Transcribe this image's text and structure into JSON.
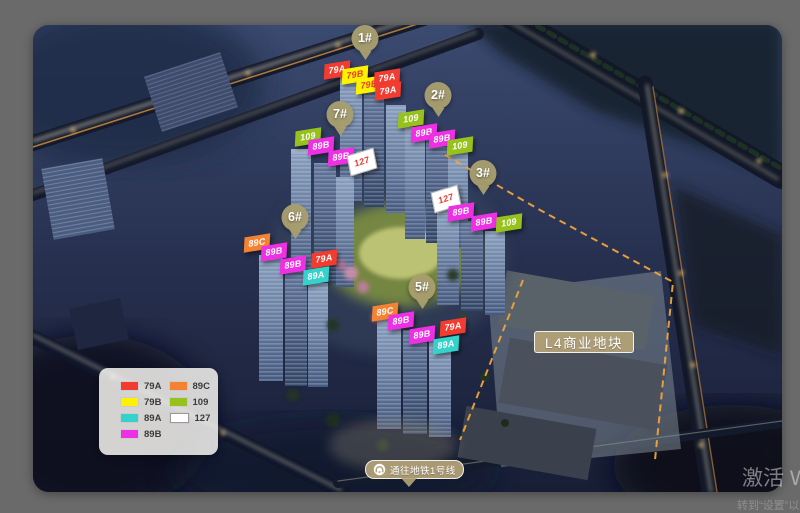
{
  "window": {
    "background_color": "#6a6a6a",
    "watermark": {
      "line1": "激活 Wi",
      "line2_partial": "转到“设置”以激活"
    }
  },
  "plan": {
    "unit_types": {
      "79A": {
        "bg": "#f23c30",
        "fg": "#ffffff"
      },
      "79B": {
        "bg": "#fdf200",
        "fg": "#e8392f"
      },
      "89A": {
        "bg": "#35d1cb",
        "fg": "#ffffff"
      },
      "89B": {
        "bg": "#ee30e4",
        "fg": "#ffffff"
      },
      "89C": {
        "bg": "#f58233",
        "fg": "#ffffff"
      },
      "109": {
        "bg": "#97c21e",
        "fg": "#ffffff"
      },
      "127": {
        "bg": "#ffffff",
        "fg": "#e8392f"
      }
    },
    "buildings": [
      {
        "name": "1#",
        "badge": {
          "x": 365,
          "y": 43
        },
        "units": [
          {
            "type": "79A",
            "x": 337,
            "y": 70
          },
          {
            "type": "79B",
            "x": 355,
            "y": 75
          },
          {
            "type": "79B",
            "x": 369,
            "y": 85
          },
          {
            "type": "79A",
            "x": 387,
            "y": 78
          },
          {
            "type": "79A",
            "x": 388,
            "y": 91
          }
        ]
      },
      {
        "name": "2#",
        "badge": {
          "x": 438,
          "y": 100
        },
        "units": [
          {
            "type": "109",
            "x": 411,
            "y": 119
          },
          {
            "type": "89B",
            "x": 424,
            "y": 133
          },
          {
            "type": "89B",
            "x": 442,
            "y": 139
          },
          {
            "type": "109",
            "x": 460,
            "y": 146
          }
        ]
      },
      {
        "name": "7#",
        "badge": {
          "x": 340,
          "y": 119
        },
        "units": [
          {
            "type": "109",
            "x": 308,
            "y": 137
          },
          {
            "type": "89B",
            "x": 321,
            "y": 146
          },
          {
            "type": "89B",
            "x": 341,
            "y": 157
          },
          {
            "type": "127",
            "x": 362,
            "y": 162
          }
        ]
      },
      {
        "name": "3#",
        "badge": {
          "x": 483,
          "y": 178
        },
        "units": [
          {
            "type": "127",
            "x": 446,
            "y": 199
          },
          {
            "type": "89B",
            "x": 461,
            "y": 212
          },
          {
            "type": "89B",
            "x": 484,
            "y": 222
          },
          {
            "type": "109",
            "x": 509,
            "y": 223
          }
        ]
      },
      {
        "name": "6#",
        "badge": {
          "x": 295,
          "y": 222
        },
        "units": [
          {
            "type": "89C",
            "x": 257,
            "y": 243
          },
          {
            "type": "89B",
            "x": 274,
            "y": 252
          },
          {
            "type": "89B",
            "x": 293,
            "y": 265
          },
          {
            "type": "79A",
            "x": 324,
            "y": 259
          },
          {
            "type": "89A",
            "x": 316,
            "y": 276
          }
        ]
      },
      {
        "name": "5#",
        "badge": {
          "x": 422,
          "y": 292
        },
        "units": [
          {
            "type": "89C",
            "x": 385,
            "y": 312
          },
          {
            "type": "89B",
            "x": 401,
            "y": 321
          },
          {
            "type": "89B",
            "x": 422,
            "y": 335
          },
          {
            "type": "79A",
            "x": 453,
            "y": 327
          },
          {
            "type": "89A",
            "x": 446,
            "y": 345
          }
        ]
      }
    ],
    "legend": {
      "columns": [
        [
          "79A",
          "79B",
          "89A",
          "89B"
        ],
        [
          "89C",
          "109",
          "127"
        ]
      ]
    },
    "labels": {
      "commercial": "L4商业地块",
      "metro": "通往地铁1号线"
    }
  }
}
